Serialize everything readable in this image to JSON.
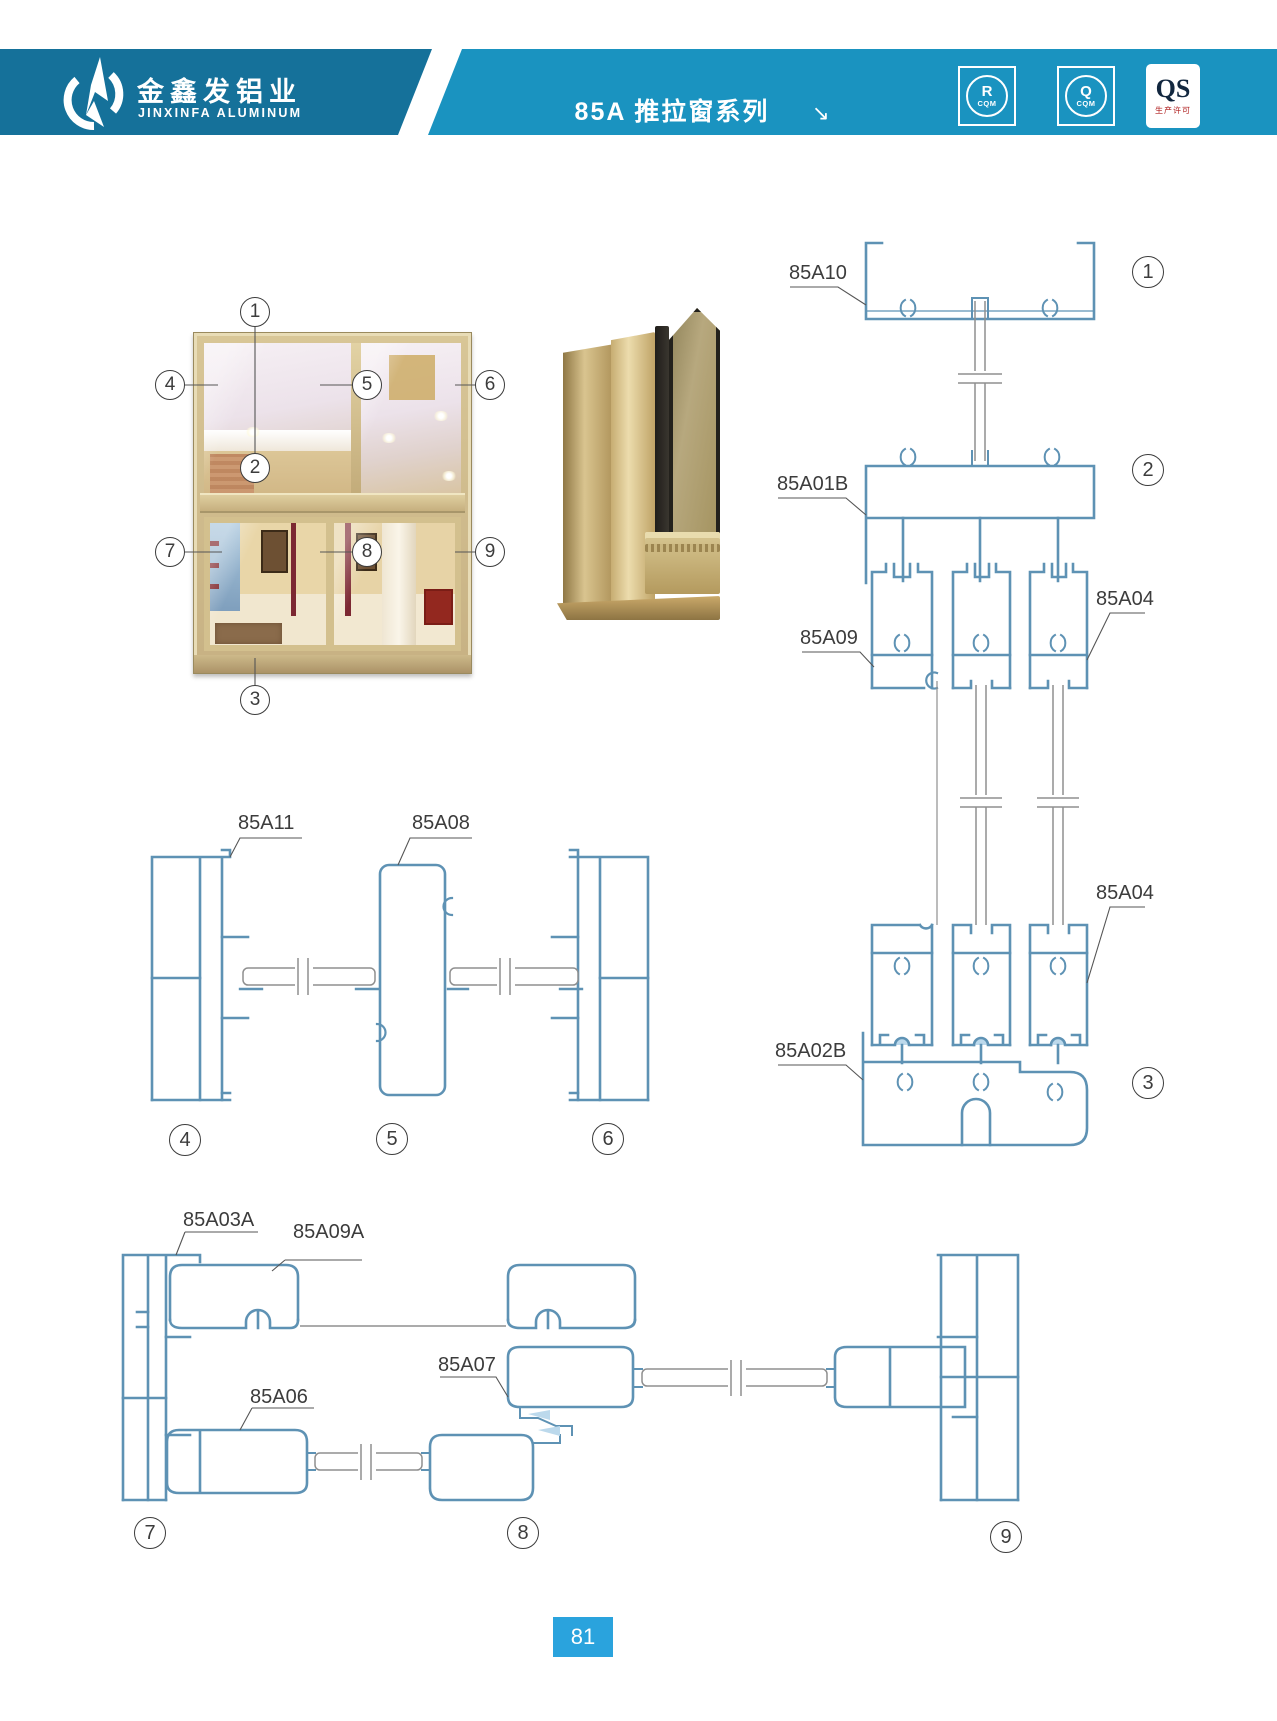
{
  "header": {
    "company_cn": "金鑫发铝业",
    "company_en": "JINXINFA ALUMINUM",
    "series_title": "85A 推拉窗系列",
    "arrow_glyph": "↘",
    "badges": [
      {
        "letter": "R",
        "caption": "CQM"
      },
      {
        "letter": "Q",
        "caption": "CQM"
      },
      {
        "letter": "QS",
        "caption": "生产许可"
      }
    ],
    "colors": {
      "left_band": "#15719a",
      "right_band": "#1a93c0"
    }
  },
  "profile_labels": {
    "p85a10": "85A10",
    "p85a01b": "85A01B",
    "p85a09": "85A09",
    "p85a04_upper": "85A04",
    "p85a04_lower": "85A04",
    "p85a02b": "85A02B",
    "p85a11": "85A11",
    "p85a08": "85A08",
    "p85a03a": "85A03A",
    "p85a09a": "85A09A",
    "p85a07": "85A07",
    "p85a06": "85A06"
  },
  "photo_callouts": [
    "1",
    "2",
    "3",
    "4",
    "5",
    "6",
    "7",
    "8",
    "9"
  ],
  "section_markers": [
    "1",
    "2",
    "3",
    "4",
    "5",
    "6",
    "7",
    "8",
    "9"
  ],
  "page_number": "81",
  "diagram_colors": {
    "profile_line": "#5e92b4",
    "profile_fill": "#bcd9ec",
    "glass_line": "#8f8f8f",
    "leader": "#555555"
  }
}
